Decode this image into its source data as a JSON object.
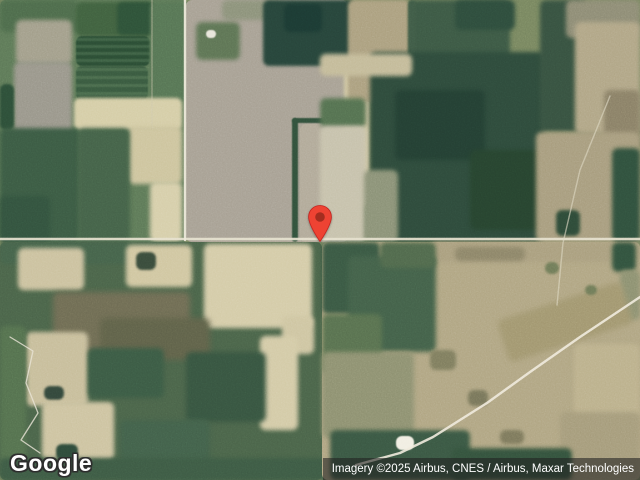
{
  "branding": {
    "logo_text": "Google"
  },
  "attribution": {
    "text": "Imagery ©2025 Airbus, CNES / Airbus, Maxar Technologies"
  },
  "map": {
    "base_color": "#77855f",
    "pin": {
      "tip_x": 320,
      "tip_y": 242,
      "width": 24,
      "height": 37,
      "body_color": "#ee4333",
      "stroke_color": "#c5221f",
      "dot_color": "#a42d1f"
    },
    "roads": [
      {
        "name": "road-horizontal",
        "points": "0,239 640,239",
        "w": 2.4,
        "c": "#e6e1cd",
        "o": 0.92
      },
      {
        "name": "road-vertical",
        "points": "185,0 185,240",
        "w": 2.4,
        "c": "#ece8d8",
        "o": 0.95
      },
      {
        "name": "road-diagonal",
        "points": "640,297 580,337 530,372 487,403 433,437 400,453 356,465",
        "w": 2.4,
        "c": "#efeadb",
        "o": 0.9
      },
      {
        "name": "track-north",
        "points": "610,96 580,170 563,243 557,305",
        "w": 1.4,
        "c": "#ded8c2",
        "o": 0.6
      },
      {
        "name": "driveway-curve",
        "points": "10,337 33,351 26,383 38,413 21,440 40,453",
        "w": 1.3,
        "c": "#e8e4d4",
        "o": 0.8
      },
      {
        "name": "field-line",
        "points": "152,0 152,126",
        "w": 1.2,
        "c": "#cfc9ae",
        "o": 0.5
      }
    ],
    "patches": [
      {
        "x": 0,
        "y": 0,
        "w": 188,
        "h": 242,
        "c": "#5d7857",
        "b": 0
      },
      {
        "x": 0,
        "y": 0,
        "w": 78,
        "h": 32,
        "c": "#4d6a4b",
        "b": 2
      },
      {
        "x": 16,
        "y": 20,
        "w": 56,
        "h": 44,
        "c": "#a29e8a",
        "b": 2
      },
      {
        "x": 14,
        "y": 62,
        "w": 58,
        "h": 80,
        "c": "#99968a",
        "b": 2
      },
      {
        "x": 76,
        "y": 2,
        "w": 78,
        "h": 34,
        "c": "#40603f",
        "b": 1.5
      },
      {
        "x": 117,
        "y": 2,
        "w": 36,
        "h": 33,
        "c": "#2e5138",
        "b": 1.5
      },
      {
        "x": 76,
        "y": 36,
        "w": 74,
        "h": 30,
        "stripe": {
          "angle": 0,
          "c1": "#2b4c34",
          "c2": "#3e6044",
          "s1": 4,
          "s2": 3
        },
        "b": 0.5
      },
      {
        "x": 76,
        "y": 66,
        "w": 72,
        "h": 34,
        "stripe": {
          "angle": 0,
          "c1": "#39593f",
          "c2": "#4a6a4c",
          "s1": 5,
          "s2": 3
        },
        "b": 0.5
      },
      {
        "x": 150,
        "y": 2,
        "w": 36,
        "h": 100,
        "c": "#567454",
        "b": 1.5
      },
      {
        "x": 0,
        "y": 84,
        "w": 14,
        "h": 46,
        "c": "#2d4e38",
        "b": 1
      },
      {
        "x": 74,
        "y": 98,
        "w": 108,
        "h": 32,
        "c": "#d5cda6",
        "b": 1.5
      },
      {
        "x": 128,
        "y": 126,
        "w": 54,
        "h": 58,
        "c": "#cdc49d",
        "b": 2
      },
      {
        "x": 150,
        "y": 182,
        "w": 32,
        "h": 60,
        "c": "#d6cea9",
        "b": 2
      },
      {
        "x": 0,
        "y": 128,
        "w": 80,
        "h": 114,
        "c": "#3b5a43",
        "b": 2
      },
      {
        "x": 78,
        "y": 128,
        "w": 52,
        "h": 114,
        "c": "#446148",
        "b": 2
      },
      {
        "x": 0,
        "y": 196,
        "w": 50,
        "h": 46,
        "c": "#33523e",
        "b": 2
      },
      {
        "x": 186,
        "y": 0,
        "w": 162,
        "h": 242,
        "c": "#a7a093",
        "b": 0
      },
      {
        "x": 222,
        "y": 0,
        "w": 60,
        "h": 20,
        "c": "#8b9179",
        "b": 2
      },
      {
        "x": 196,
        "y": 22,
        "w": 44,
        "h": 38,
        "c": "#5d7354",
        "b": 2
      },
      {
        "x": 206,
        "y": 30,
        "w": 10,
        "h": 8,
        "c": "#e8e5da",
        "b": 0.5
      },
      {
        "x": 263,
        "y": 0,
        "w": 92,
        "h": 66,
        "c": "#27443a",
        "b": 1.5
      },
      {
        "x": 284,
        "y": 4,
        "w": 38,
        "h": 28,
        "c": "#1c3a33",
        "b": 1.5
      },
      {
        "x": 292,
        "y": 118,
        "w": 56,
        "h": 5,
        "c": "#31503b",
        "b": 0.5
      },
      {
        "x": 292,
        "y": 118,
        "w": 6,
        "h": 124,
        "c": "#31503b",
        "b": 0.5
      },
      {
        "x": 300,
        "y": 124,
        "w": 48,
        "h": 118,
        "c": "#b1a998",
        "b": 0
      },
      {
        "x": 344,
        "y": 60,
        "w": 26,
        "h": 146,
        "c": "#d0c7a2",
        "b": 1.5
      },
      {
        "x": 348,
        "y": 0,
        "w": 62,
        "h": 102,
        "c": "#ab9f7e",
        "b": 1.5
      },
      {
        "x": 410,
        "y": 0,
        "w": 100,
        "h": 58,
        "c": "#3c5844",
        "b": 2
      },
      {
        "x": 455,
        "y": 0,
        "w": 60,
        "h": 30,
        "c": "#2e4c3c",
        "b": 2
      },
      {
        "x": 408,
        "y": 0,
        "w": 8,
        "h": 56,
        "c": "#3f5a46",
        "b": 1
      },
      {
        "x": 370,
        "y": 52,
        "w": 175,
        "h": 190,
        "c": "#2e4a3b",
        "b": 2
      },
      {
        "x": 395,
        "y": 90,
        "w": 90,
        "h": 70,
        "c": "#243f33",
        "b": 2.5
      },
      {
        "x": 470,
        "y": 150,
        "w": 90,
        "h": 80,
        "c": "#27432f",
        "b": 2.5
      },
      {
        "x": 540,
        "y": 0,
        "w": 46,
        "h": 132,
        "c": "#375140",
        "b": 2
      },
      {
        "x": 566,
        "y": 0,
        "w": 74,
        "h": 38,
        "c": "#8d8b74",
        "b": 2
      },
      {
        "x": 575,
        "y": 22,
        "w": 65,
        "h": 112,
        "c": "#b0a585",
        "b": 2
      },
      {
        "x": 604,
        "y": 90,
        "w": 36,
        "h": 58,
        "c": "#897f66",
        "b": 2
      },
      {
        "x": 536,
        "y": 132,
        "w": 104,
        "h": 110,
        "c": "#a79c7d",
        "b": 2
      },
      {
        "x": 612,
        "y": 148,
        "w": 28,
        "h": 94,
        "c": "#30503d",
        "b": 2
      },
      {
        "x": 556,
        "y": 210,
        "w": 24,
        "h": 26,
        "c": "#2e4a38",
        "b": 1.5
      },
      {
        "x": 320,
        "y": 54,
        "w": 92,
        "h": 22,
        "c": "#c3ba98",
        "b": 2
      },
      {
        "x": 320,
        "y": 98,
        "w": 46,
        "h": 30,
        "c": "#547050",
        "b": 2
      },
      {
        "x": 320,
        "y": 126,
        "w": 46,
        "h": 116,
        "c": "#c6c1ab",
        "b": 2
      },
      {
        "x": 364,
        "y": 170,
        "w": 34,
        "h": 72,
        "c": "#8a9176",
        "b": 2
      },
      {
        "x": 0,
        "y": 242,
        "w": 322,
        "h": 238,
        "c": "#4a6349",
        "b": 0
      },
      {
        "x": 0,
        "y": 242,
        "w": 188,
        "h": 22,
        "c": "#45624a",
        "b": 1.5
      },
      {
        "x": 18,
        "y": 248,
        "w": 66,
        "h": 42,
        "c": "#cbc19e",
        "b": 2
      },
      {
        "x": 126,
        "y": 245,
        "w": 66,
        "h": 42,
        "c": "#d0c6a0",
        "b": 2
      },
      {
        "x": 136,
        "y": 252,
        "w": 20,
        "h": 18,
        "c": "#394b3b",
        "b": 1
      },
      {
        "x": 204,
        "y": 244,
        "w": 108,
        "h": 84,
        "c": "#d4cba7",
        "b": 2
      },
      {
        "x": 282,
        "y": 316,
        "w": 32,
        "h": 38,
        "c": "#cec5a1",
        "b": 2
      },
      {
        "x": 260,
        "y": 336,
        "w": 38,
        "h": 94,
        "c": "#d3caa6",
        "b": 2
      },
      {
        "x": 53,
        "y": 292,
        "w": 137,
        "h": 60,
        "c": "#6e6b53",
        "b": 3
      },
      {
        "x": 100,
        "y": 318,
        "w": 110,
        "h": 42,
        "c": "#5f6149",
        "b": 3
      },
      {
        "x": 26,
        "y": 332,
        "w": 62,
        "h": 74,
        "c": "#c7bd9a",
        "b": 2
      },
      {
        "x": 44,
        "y": 386,
        "w": 20,
        "h": 14,
        "c": "#33473b",
        "b": 1
      },
      {
        "x": 42,
        "y": 402,
        "w": 72,
        "h": 58,
        "c": "#cdc3a0",
        "b": 2
      },
      {
        "x": 0,
        "y": 326,
        "w": 26,
        "h": 136,
        "c": "#54704e",
        "b": 2
      },
      {
        "x": 88,
        "y": 348,
        "w": 76,
        "h": 50,
        "c": "#3b5a44",
        "b": 2.5
      },
      {
        "x": 186,
        "y": 352,
        "w": 80,
        "h": 70,
        "c": "#375440",
        "b": 2.5
      },
      {
        "x": 120,
        "y": 420,
        "w": 90,
        "h": 60,
        "c": "#42604a",
        "b": 2.5
      },
      {
        "x": 0,
        "y": 458,
        "w": 330,
        "h": 22,
        "c": "#3d5a44",
        "b": 2
      },
      {
        "x": 56,
        "y": 444,
        "w": 22,
        "h": 16,
        "c": "#2e4a3a",
        "b": 1
      },
      {
        "x": 322,
        "y": 242,
        "w": 318,
        "h": 238,
        "c": "#b0a582",
        "b": 0
      },
      {
        "x": 430,
        "y": 242,
        "w": 210,
        "h": 20,
        "c": "#a99e7d",
        "b": 2
      },
      {
        "x": 455,
        "y": 247,
        "w": 70,
        "h": 14,
        "c": "#8c8468",
        "b": 2
      },
      {
        "x": 612,
        "y": 242,
        "w": 24,
        "h": 30,
        "c": "#32523e",
        "b": 2
      },
      {
        "x": 620,
        "y": 270,
        "w": 20,
        "h": 50,
        "c": "#8c9070",
        "b": 2
      },
      {
        "x": 322,
        "y": 242,
        "w": 58,
        "h": 72,
        "c": "#3a5843",
        "b": 2
      },
      {
        "x": 348,
        "y": 256,
        "w": 88,
        "h": 96,
        "c": "#436049",
        "b": 2.5
      },
      {
        "x": 380,
        "y": 242,
        "w": 56,
        "h": 26,
        "c": "#50684c",
        "b": 2
      },
      {
        "x": 322,
        "y": 314,
        "w": 60,
        "h": 60,
        "c": "#58704f",
        "b": 2.5
      },
      {
        "x": 322,
        "y": 352,
        "w": 92,
        "h": 86,
        "c": "#8d9070",
        "b": 2.5
      },
      {
        "x": 500,
        "y": 300,
        "w": 130,
        "h": 44,
        "c": "#a1966f",
        "b": 3,
        "rot": -18
      },
      {
        "x": 574,
        "y": 344,
        "w": 66,
        "h": 74,
        "c": "#bbb08b",
        "b": 2
      },
      {
        "x": 560,
        "y": 412,
        "w": 80,
        "h": 68,
        "c": "#a59b7a",
        "b": 2
      },
      {
        "x": 330,
        "y": 430,
        "w": 140,
        "h": 50,
        "c": "#3a5743",
        "b": 2
      },
      {
        "x": 452,
        "y": 448,
        "w": 120,
        "h": 32,
        "c": "#34523d",
        "b": 2
      },
      {
        "x": 430,
        "y": 350,
        "w": 26,
        "h": 20,
        "c": "#7e7c5e",
        "b": 1.5
      },
      {
        "x": 468,
        "y": 390,
        "w": 20,
        "h": 16,
        "c": "#77755a",
        "b": 1.5
      },
      {
        "x": 500,
        "y": 430,
        "w": 24,
        "h": 14,
        "c": "#7c785c",
        "b": 1.5
      },
      {
        "x": 545,
        "y": 262,
        "w": 14,
        "h": 12,
        "c": "#6f7a58",
        "b": 1
      },
      {
        "x": 585,
        "y": 285,
        "w": 12,
        "h": 10,
        "c": "#6f7a58",
        "b": 1
      },
      {
        "x": 396,
        "y": 436,
        "w": 18,
        "h": 14,
        "c": "#f1eee2",
        "b": 0.5
      }
    ]
  }
}
